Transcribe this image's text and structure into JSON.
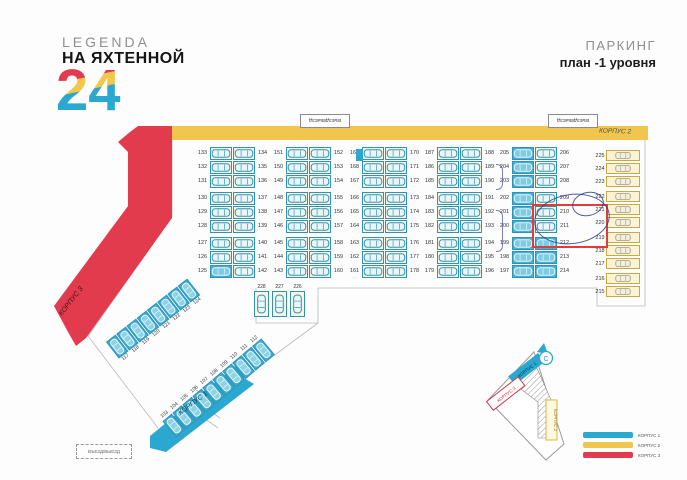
{
  "header": {
    "brand_top": "LEGENDA",
    "brand_main": "НА ЯХТЕННОЙ",
    "brand_number": "24",
    "plan_title": "ПАРКИНГ",
    "plan_subtitle": "план -1 уровня"
  },
  "labels": {
    "entrance_top_1": "ВЪЕЗД/ВЫЕЗД",
    "entrance_top_2": "ВЪЕЗД/ВЫЕЗД",
    "entrance_bottom": "ВЪЕЗД/ВЫЕЗД",
    "korpus1": "КОРПУС 1",
    "korpus2": "КОРПУС 2",
    "korpus3": "КОРПУС 3",
    "compass": "С"
  },
  "colors": {
    "teal": "#2BA8CF",
    "yellow": "#F0C64F",
    "red": "#E23B4E",
    "highlight_red": "#E23B3B",
    "pen_blue": "#2F4193"
  },
  "parking": {
    "groups": [
      {
        "left": [
          133,
          132,
          131,
          130,
          129,
          128,
          127,
          126,
          125
        ],
        "right": [
          134,
          135,
          136,
          137,
          138,
          139,
          140,
          141,
          142
        ]
      },
      {
        "left": [
          151,
          150,
          149,
          148,
          147,
          146,
          145,
          144,
          143
        ],
        "right": [
          152,
          153,
          154,
          155,
          156,
          157,
          158,
          159,
          160
        ]
      },
      {
        "left": [
          169,
          168,
          167,
          166,
          165,
          164,
          163,
          162,
          161
        ],
        "right": [
          170,
          171,
          172,
          173,
          174,
          175,
          176,
          177,
          178
        ]
      },
      {
        "left": [
          187,
          186,
          185,
          184,
          183,
          182,
          181,
          180,
          179
        ],
        "right": [
          188,
          189,
          190,
          191,
          192,
          193,
          194,
          195,
          196
        ]
      },
      {
        "left": [
          205,
          204,
          203,
          202,
          201,
          200,
          199,
          198,
          197
        ],
        "right": [
          206,
          207,
          208,
          209,
          210,
          211,
          212,
          213,
          214
        ]
      }
    ],
    "right_column": [
      225,
      224,
      223,
      222,
      221,
      220,
      219,
      218,
      217,
      216,
      215
    ],
    "bottom_row": [
      228,
      227,
      226
    ],
    "diagonal_row_upper": [
      117,
      118,
      119,
      120,
      121,
      122,
      123,
      124
    ],
    "diagonal_row_lower": [
      103,
      104,
      105,
      106,
      107,
      108,
      109,
      110,
      111,
      112
    ]
  },
  "annotations": {
    "highlighted_spaces": [
      210,
      211
    ]
  },
  "legend": [
    {
      "label": "КОРПУС 1",
      "color": "#2BA8CF"
    },
    {
      "label": "КОРПУС 2",
      "color": "#F0C64F"
    },
    {
      "label": "КОРПУС 3",
      "color": "#E23B4E"
    }
  ]
}
